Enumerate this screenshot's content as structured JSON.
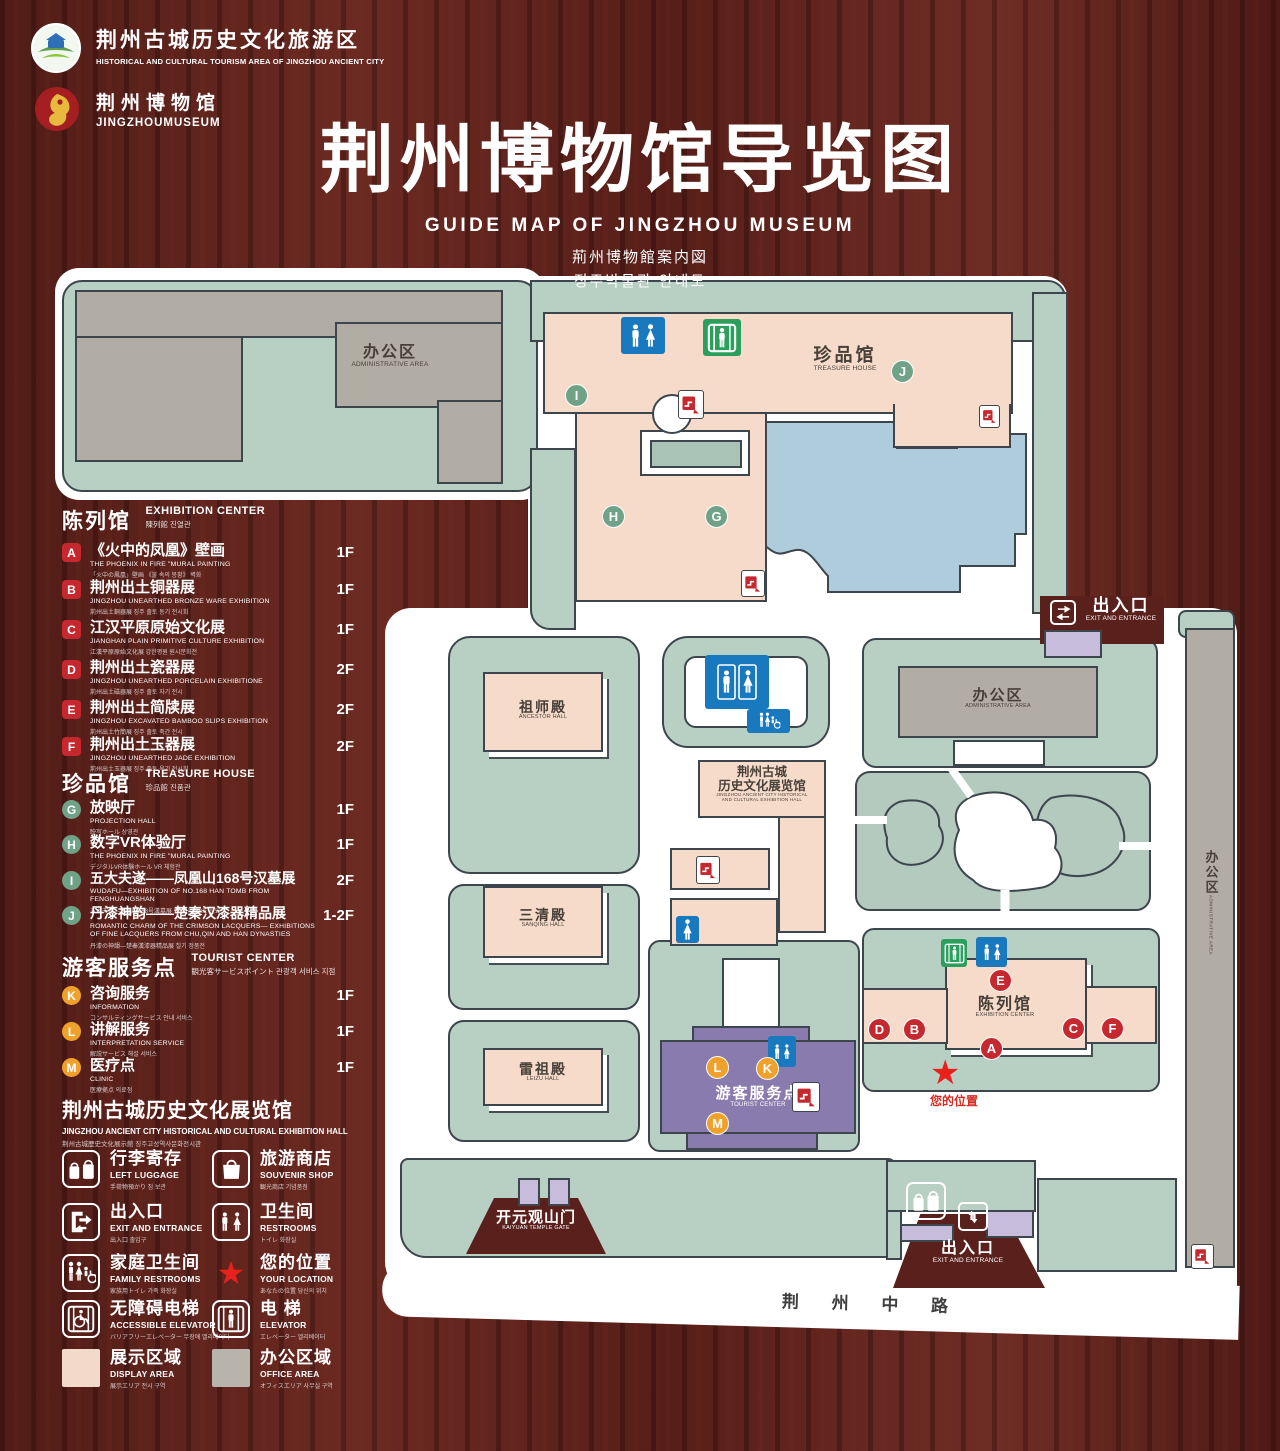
{
  "colors": {
    "accent_red": "#c5292f",
    "sign_blue": "#1879bf",
    "sign_green": "#2ba05c",
    "display_area_pink": "#f6d9c9",
    "office_area_gray": "#b2ada4",
    "star_red": "#e8211d",
    "wood": "#5a201c",
    "marker_green": "#6fa287",
    "marker_orange": "#f0a12b"
  },
  "header": {
    "org": {
      "zh": "荆州古城历史文化旅游区",
      "en": "HISTORICAL AND CULTURAL TOURISM AREA OF JINGZHOU ANCIENT CITY"
    },
    "museum": {
      "zh": "荆州博物馆",
      "en": "JINGZHOUMUSEUM"
    },
    "title": {
      "zh": "荆州博物馆导览图",
      "en": "GUIDE MAP OF JINGZHOU MUSEUM",
      "ja": "荊州博物館案内図",
      "ko": "징주박물관 안내도"
    }
  },
  "legend": {
    "sections": [
      {
        "title_zh": "陈列馆",
        "title_en": "EXHIBITION CENTER",
        "title_sub": "陳列館  진열관",
        "items": [
          {
            "letter": "A",
            "zh": "《火中的凤凰》壁画",
            "en": "THE PHOENIX IN FIRE \"MURAL PAINTING",
            "sub": "「火中の鳳凰」壁画 《불 속의 봉황》 벽화",
            "floor": "1F"
          },
          {
            "letter": "B",
            "zh": "荆州出土铜器展",
            "en": "JINGZHOU UNEARTHED BRONZE WARE EXHIBITION",
            "sub": "荊州出土銅器展 징주 출토 동기 전시회",
            "floor": "1F"
          },
          {
            "letter": "C",
            "zh": "江汉平原原始文化展",
            "en": "JIANGHAN PLAIN PRIMITIVE CULTURE EXHIBITION",
            "sub": "江漢平原原始文化展 강한평원 원시문화전",
            "floor": "1F"
          },
          {
            "letter": "D",
            "zh": "荆州出土瓷器展",
            "en": "JINGZHOU UNEARTHED PORCELAIN EXHIBITIONE",
            "sub": "荊州出土磁器展 징주 출토 자기 전시",
            "floor": "2F"
          },
          {
            "letter": "E",
            "zh": "荆州出土简牍展",
            "en": "JINGZHOU EXCAVATED BAMBOO SLIPS EXHIBITION",
            "sub": "荊州出土竹簡展 징주 출토 죽간 전시",
            "floor": "2F"
          },
          {
            "letter": "F",
            "zh": "荆州出土玉器展",
            "en": "JINGZHOU UNEARTHED JADE EXHIBITION",
            "sub": "荊州出土玉器展 징주 출토 옥기 전시회",
            "floor": "2F"
          }
        ]
      },
      {
        "title_zh": "珍品馆",
        "title_en": "TREASURE HOUSE",
        "title_sub": "珍品館  진품관",
        "items": [
          {
            "letter": "G",
            "zh": "放映厅",
            "en": "PROJECTION HALL",
            "sub": "映写ホール 상영관",
            "floor": "1F"
          },
          {
            "letter": "H",
            "zh": "数字VR体验厅",
            "en": "THE PHOENIX IN FIRE \"MURAL PAINTING",
            "sub": "デジタルVR体験ホール VR 체험관",
            "floor": "1F"
          },
          {
            "letter": "I",
            "zh": "五大夫遂——凤凰山168号汉墓展",
            "en": "WUDAFU—EXHIBITION OF NO.168 HAN TOMB FROM FENGHUANGSHAN",
            "sub": "五大夫遂—鳳凰山168号漢墓展 봉황산 168호 한묘전",
            "floor": "2F"
          },
          {
            "letter": "J",
            "zh": "丹漆神韵——楚秦汉漆器精品展",
            "en": "ROMANTIC CHARM OF THE CRIMSON LACQUERS— EXHIBITIONS OF FINE LACQUERS FROM CHU,QIN AND HAN DYNASTIES",
            "sub": "丹漆の神韻—楚秦漢漆器精品展 칠기 정품전",
            "floor": "1-2F"
          }
        ]
      },
      {
        "title_zh": "游客服务点",
        "title_en": "TOURIST CENTER",
        "title_sub": "観光客サービスポイント  관광객 서비스 지점",
        "items": [
          {
            "letter": "K",
            "zh": "咨询服务",
            "en": "INFORMATION",
            "sub": "コンサルティングサービス 안내 서비스",
            "floor": "1F"
          },
          {
            "letter": "L",
            "zh": "讲解服务",
            "en": "INTERPRETATION SERVICE",
            "sub": "解説サービス 해설 서비스",
            "floor": "1F"
          },
          {
            "letter": "M",
            "zh": "医疗点",
            "en": "CLINIC",
            "sub": "医療拠点 의료점",
            "floor": "1F"
          }
        ]
      }
    ],
    "hall_note": {
      "zh": "荆州古城历史文化展览馆",
      "en": "JINGZHOU ANCIENT CITY HISTORICAL AND CULTURAL EXHIBITION HALL",
      "sub": "荆州古城歴史文化展示館  징주고성역사문화전시관"
    },
    "icons": [
      {
        "name": "left-luggage",
        "zh": "行李寄存",
        "en": "LEFT LUGGAGE",
        "sub": "手荷物預かり 짐 보관"
      },
      {
        "name": "souvenir-shop",
        "zh": "旅游商店",
        "en": "SOUVENIR SHOP",
        "sub": "観光商店 기념품점"
      },
      {
        "name": "exit-entrance",
        "zh": "出入口",
        "en": "EXIT AND ENTRANCE",
        "sub": "出入口 출입구"
      },
      {
        "name": "restrooms",
        "zh": "卫生间",
        "en": "RESTROOMS",
        "sub": "トイレ 화장실"
      },
      {
        "name": "family-restrooms",
        "zh": "家庭卫生间",
        "en": "FAMILY RESTROOMS",
        "sub": "家族用トイレ 가족 화장실"
      },
      {
        "name": "your-location",
        "zh": "您的位置",
        "en": "YOUR LOCATION",
        "sub": "あなたの位置 당신의 위치"
      },
      {
        "name": "accessible-elevator",
        "zh": "无障碍电梯",
        "en": "ACCESSIBLE ELEVATOR",
        "sub": "バリアフリーエレベーター 무장애 엘리베이터"
      },
      {
        "name": "elevator",
        "zh": "电  梯",
        "en": "ELEVATOR",
        "sub": "エレベーター 엘리베이터"
      },
      {
        "name": "display-area",
        "zh": "展示区域",
        "en": "DISPLAY AREA",
        "sub": "展示エリア 전시 구역"
      },
      {
        "name": "office-area",
        "zh": "办公区域",
        "en": "OFFICE AREA",
        "sub": "オフィスエリア 사무실 구역"
      }
    ]
  },
  "map": {
    "labels": {
      "admin": {
        "zh": "办公区",
        "en": "ADMINISTRATIVE AREA"
      },
      "treasure": {
        "zh": "珍品馆",
        "en": "TREASURE HOUSE"
      },
      "exit": {
        "zh": "出入口",
        "en": "EXIT AND ENTRANCE"
      },
      "ancestor": {
        "zh": "祖师殿",
        "en": "ANCESTOR HALL"
      },
      "sanqing": {
        "zh": "三清殿",
        "en": "SANQING HALL"
      },
      "leizu": {
        "zh": "雷祖殿",
        "en": "LEIZU HALL"
      },
      "exhib_hall": {
        "zh1": "荆州古城",
        "zh2": "历史文化展览馆",
        "en1": "JINGZHOU ANCIENT CITY HISTORICAL",
        "en2": "AND CULTURAL EXHIBITION HALL"
      },
      "tourist": {
        "zh": "游客服务点",
        "en": "TOURIST CENTER"
      },
      "exhibition": {
        "zh": "陈列馆",
        "en": "EXHIBITION CENTER"
      },
      "your_location": {
        "zh": "您的位置"
      },
      "gate": {
        "zh": "开元观山门",
        "en": "KAIYUAN TEMPLE GATE"
      },
      "road": {
        "zh": "荆 州 中 路"
      }
    },
    "markers": {
      "treasure": [
        "I",
        "J",
        "H",
        "G"
      ],
      "exhibition": [
        "E",
        "D",
        "B",
        "A",
        "C",
        "F"
      ],
      "tourist": [
        "L",
        "K",
        "M"
      ]
    }
  }
}
